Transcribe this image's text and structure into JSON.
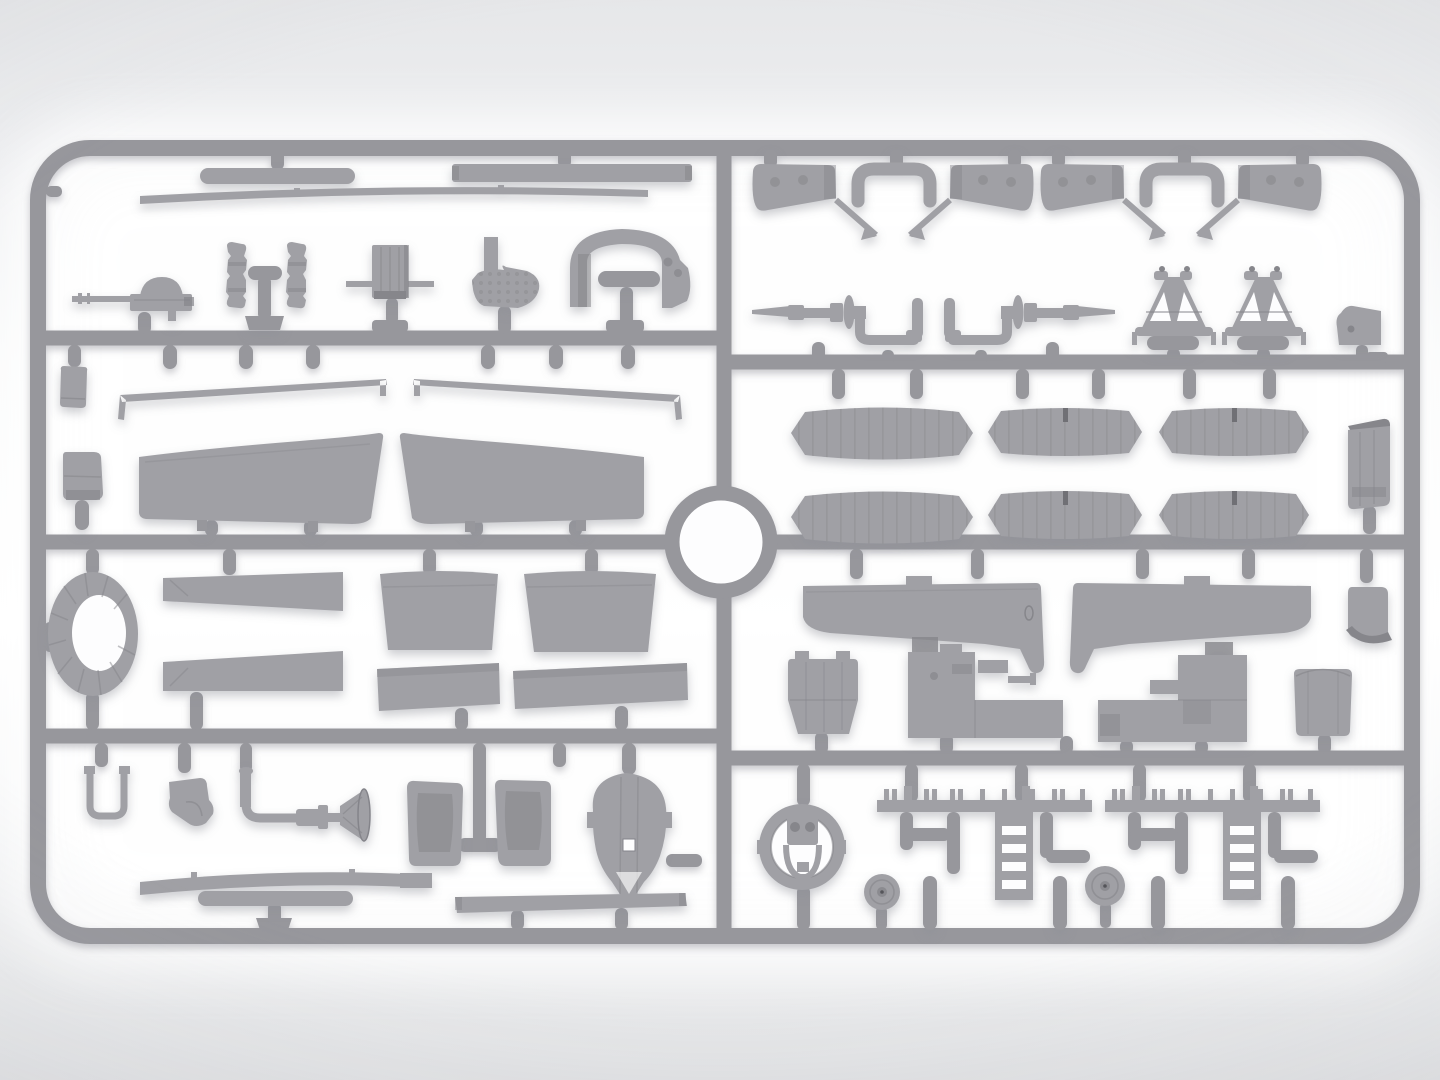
{
  "meta": {
    "subject": "Top-down render of a gray injection-molded plastic model kit sprue (aircraft parts frame) on a bright studio background",
    "image_type": "product-render",
    "visible_text": ""
  },
  "theme": {
    "bg_top": "#e6e7e9",
    "bg_mid": "#ffffff",
    "bg_bottom": "#e1e2e4",
    "glow": "#ffffff",
    "sprue_main": "#97979c",
    "sprue_light": "#a9a9ad",
    "sprue_dark": "#7f7f84",
    "part_main": "#a0a0a5",
    "part_light": "#b2b2b6",
    "part_dark": "#86868b",
    "hole": "#fdfdfe",
    "shadow": "#8e8f97"
  },
  "sprue": {
    "frame": "rounded-rectangle outer runner with a central vertical runner, three horizontal runners per half and a circular locating ring at the center",
    "sections": [
      {
        "id": "left-top",
        "parts": [
          "capsule-bar",
          "tapered-strip",
          "flat-bar",
          "machine-gun",
          "side-frame-a",
          "side-frame-b",
          "radiator-box",
          "perforated-bracket",
          "cockpit-coaming"
        ]
      },
      {
        "id": "left-upper-middle",
        "parts": [
          "small-box",
          "tall-box",
          "wing-spar-left",
          "wing-spar-right",
          "upper-wing-left",
          "upper-wing-right"
        ]
      },
      {
        "id": "left-lower-middle",
        "parts": [
          "cowl-ring-oval",
          "tapered-panel-a",
          "tapered-panel-b",
          "flap-panel-a",
          "flap-panel-b",
          "rect-panel-a",
          "rect-panel-b"
        ]
      },
      {
        "id": "left-bottom",
        "parts": [
          "u-hook",
          "corner-bracket",
          "control-column",
          "seat-frame-a",
          "seat-frame-b",
          "t-runner-pin",
          "teardrop-cowl-panel",
          "arched-strip",
          "capsule-bar-short",
          "straight-strip"
        ]
      },
      {
        "id": "right-top",
        "parts": [
          "cabane-strut-assembly-a",
          "cabane-strut-assembly-b",
          "axle-shaft-left",
          "axle-shaft-right",
          "a-frame-pylon-a",
          "a-frame-pylon-b",
          "angled-plate"
        ]
      },
      {
        "id": "right-upper-middle",
        "parts": [
          "ribbed-panel-1",
          "ribbed-panel-2",
          "ribbed-panel-3",
          "ribbed-panel-4",
          "ribbed-panel-5",
          "ribbed-panel-6",
          "fuel-tank-box"
        ]
      },
      {
        "id": "right-lower-middle",
        "parts": [
          "lower-wing-left",
          "lower-wing-right",
          "fairing-boot",
          "crankcase-block",
          "engine-block-a",
          "engine-block-b",
          "cylinder-drum"
        ]
      },
      {
        "id": "right-bottom",
        "parts": [
          "engine-cowl-ring",
          "wheel-disc-a",
          "wheel-disc-b",
          "longeron-rail-assembly-a",
          "longeron-rail-assembly-b"
        ]
      }
    ]
  }
}
